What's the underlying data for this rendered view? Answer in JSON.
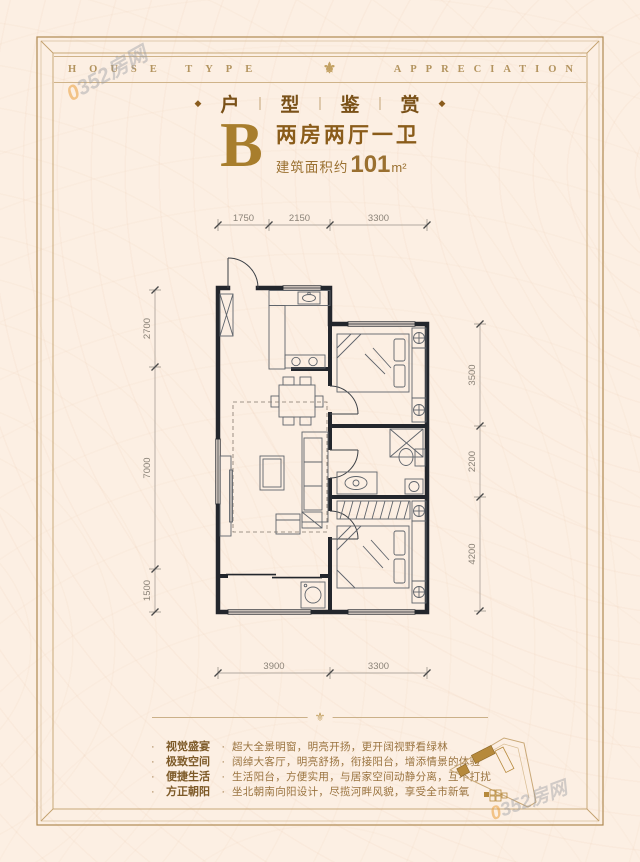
{
  "ornaments": {
    "fleur": "⚜",
    "diamond": "◆",
    "separator": "|",
    "dot": "·"
  },
  "watermark": {
    "digit": "0",
    "rest": "352房网"
  },
  "header": {
    "left": "HOUSE TYPE",
    "right": "APPRECIATION"
  },
  "subtitle": {
    "chars": [
      "户",
      "型",
      "鉴",
      "赏"
    ]
  },
  "unit": {
    "letter": "B",
    "title": "两房两厅一卫",
    "area_prefix": "建筑面积约",
    "area_value": "101",
    "area_unit": "m²"
  },
  "floorplan": {
    "dims": {
      "top": [
        "1750",
        "2150",
        "3300"
      ],
      "left": [
        "2700",
        "7000",
        "1500"
      ],
      "right": [
        "3500",
        "2200",
        "4200"
      ],
      "bottom": [
        "3900",
        "3300"
      ]
    }
  },
  "features": [
    {
      "label": "视觉盛宴",
      "text": "超大全景明窗，明亮开扬，更开阔视野看绿林"
    },
    {
      "label": "极致空间",
      "text": "阔绰大客厅，明亮舒扬，衔接阳台，增添情景的体验"
    },
    {
      "label": "便捷生活",
      "text": "生活阳台，方便实用，与居家空间动静分离，互不打扰"
    },
    {
      "label": "方正朝阳",
      "text": "坐北朝南向阳设计，尽揽河畔风貌，享受全市新氧"
    }
  ],
  "colors": {
    "accent_gold": "#b08a52",
    "wall": "#23262c",
    "title_brown": "#8a5c1a",
    "background": "#fcefe3"
  }
}
